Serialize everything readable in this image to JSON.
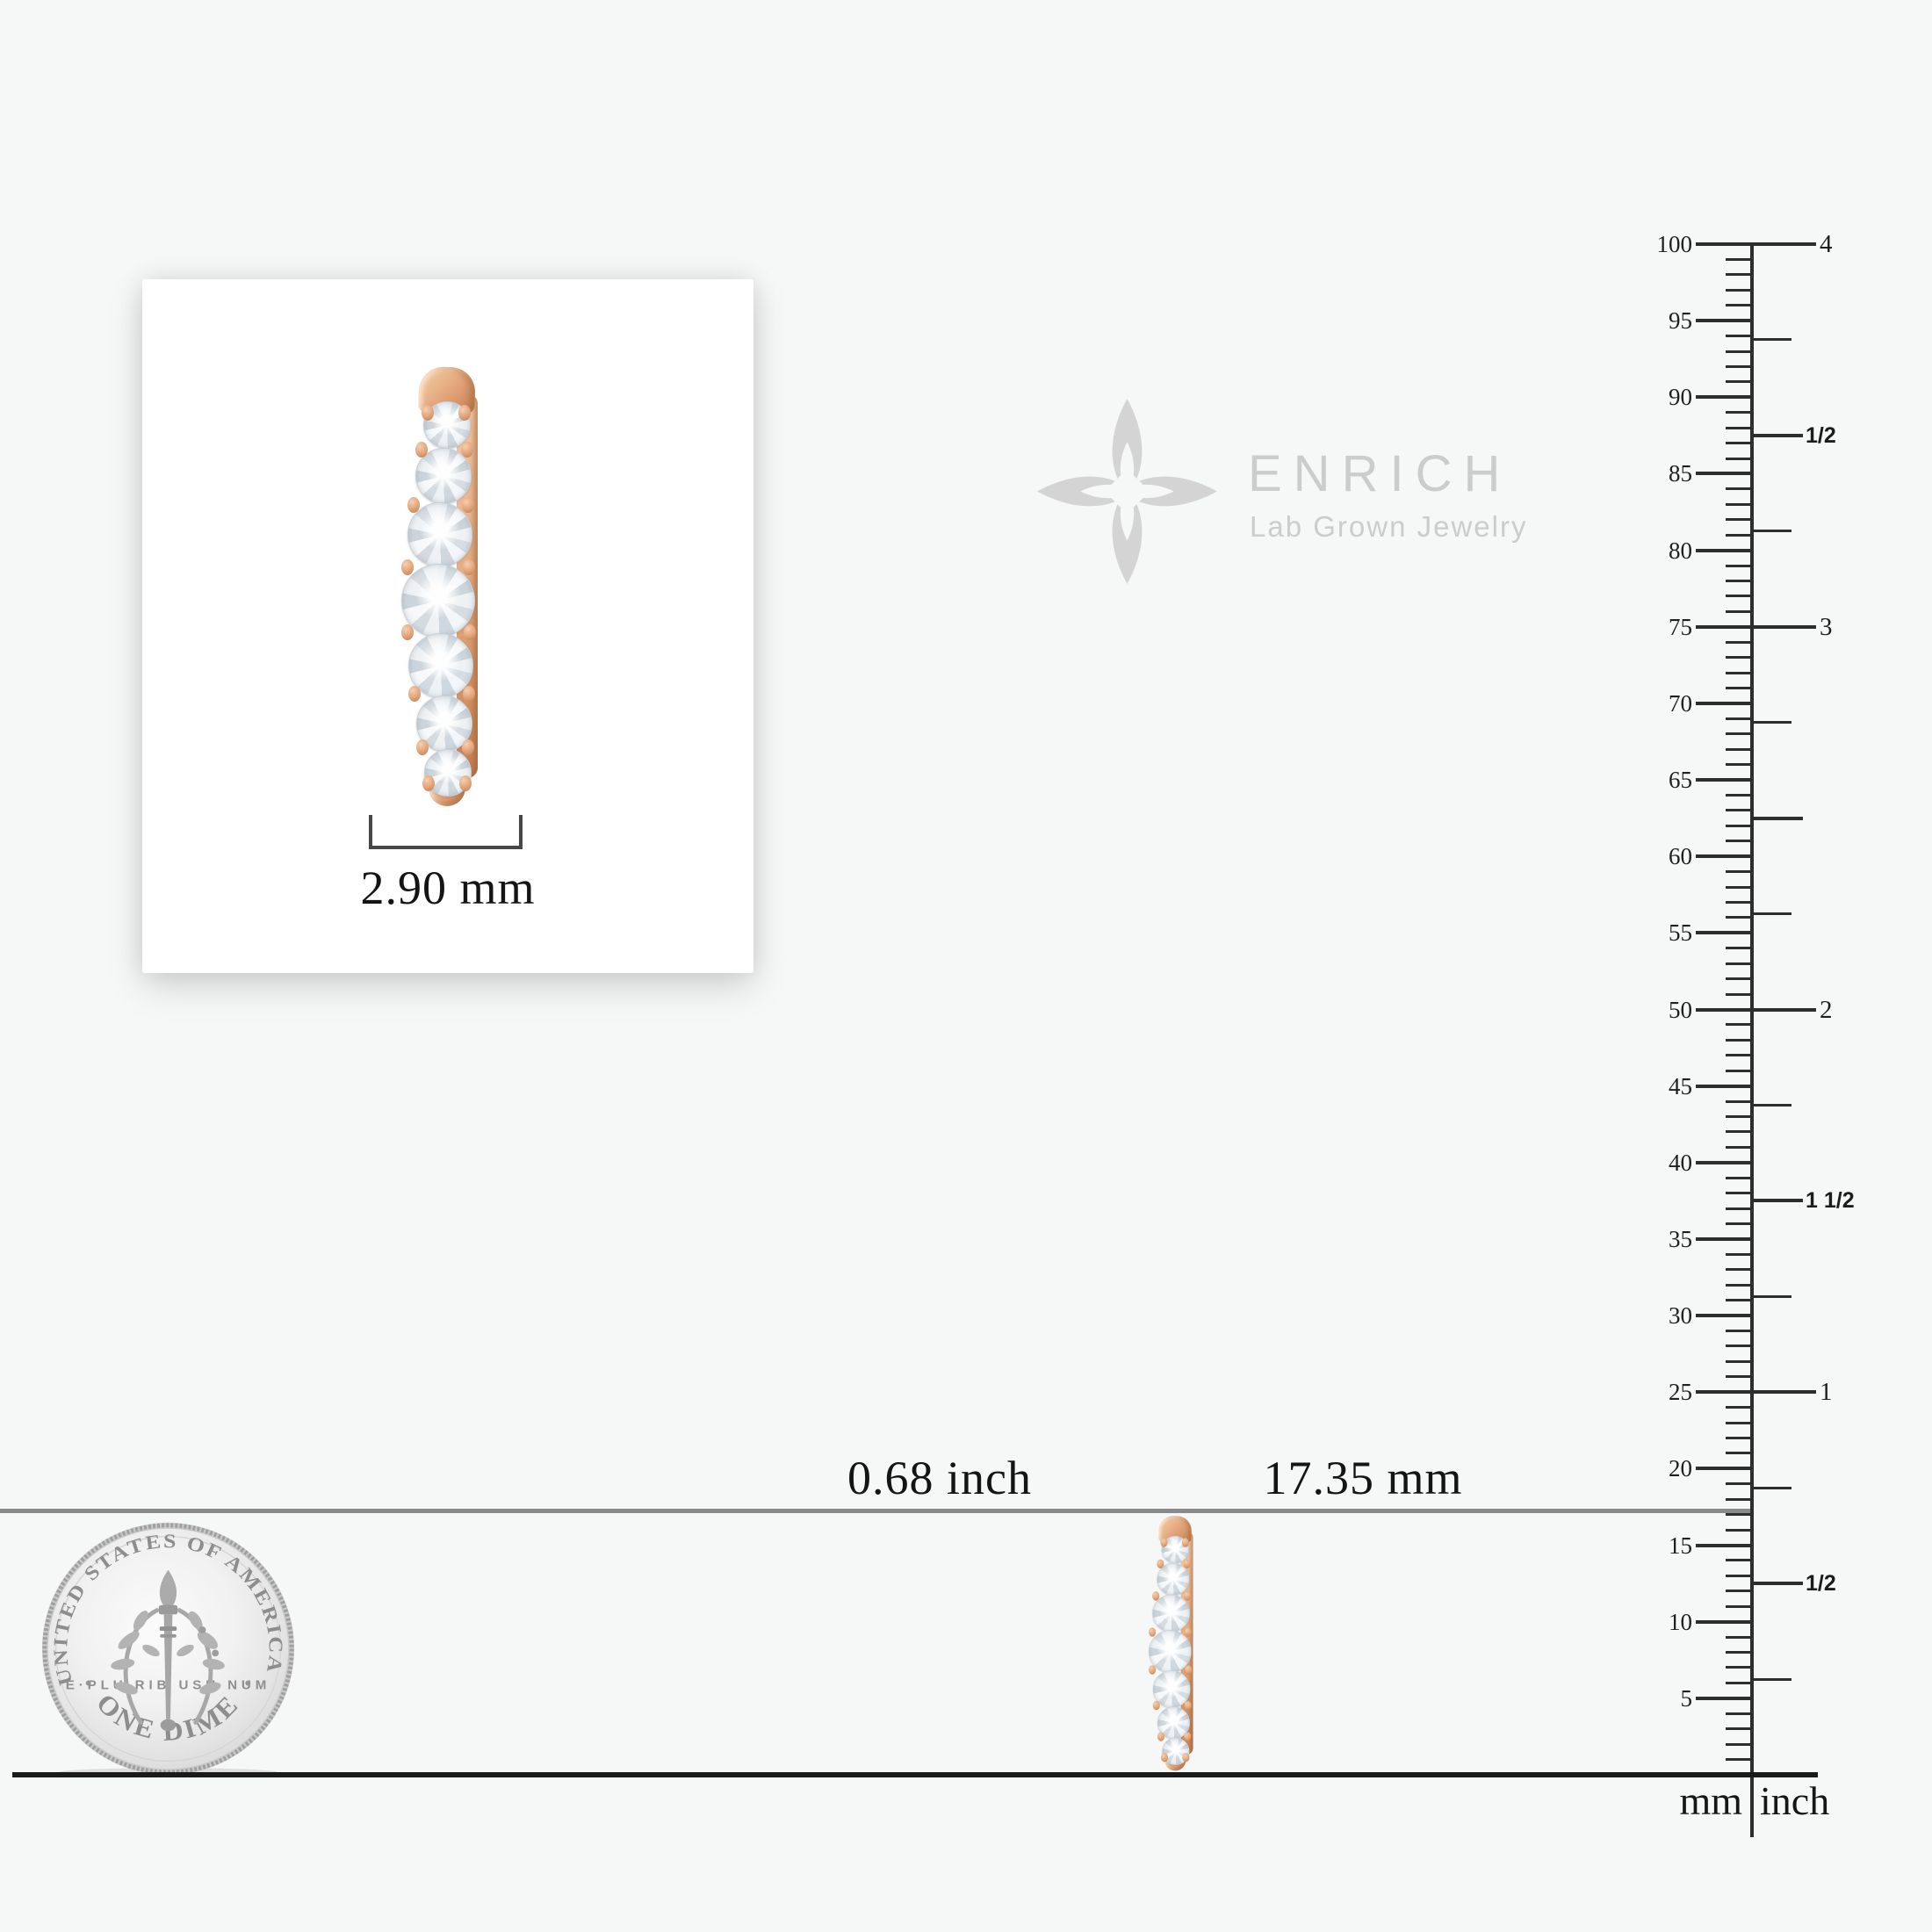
{
  "brand": {
    "name": "ENRICH",
    "tagline": "Lab Grown Jewelry"
  },
  "card_measurement": {
    "width_label": "2.90 mm"
  },
  "scale_labels": {
    "inch": "0.68 inch",
    "mm": "17.35 mm"
  },
  "ruler": {
    "mm_labels": [
      100,
      95,
      90,
      85,
      80,
      75,
      70,
      65,
      60,
      55,
      50,
      45,
      40,
      35,
      30,
      25,
      20,
      15,
      10,
      5
    ],
    "inch_labels": [
      {
        "text": "4",
        "mm": 100,
        "style": "serif"
      },
      {
        "text": "1/2",
        "mm": 87.5,
        "style": "bold"
      },
      {
        "text": "3",
        "mm": 75,
        "style": "serif"
      },
      {
        "text": "2",
        "mm": 50,
        "style": "serif"
      },
      {
        "text": "1 1/2",
        "mm": 37.5,
        "style": "bold"
      },
      {
        "text": "1",
        "mm": 25,
        "style": "serif"
      },
      {
        "text": "1/2",
        "mm": 12.5,
        "style": "bold"
      }
    ],
    "unit_left": "mm",
    "unit_right": "inch"
  },
  "coin": {
    "top_text": "UNITED STATES OF AMERICA",
    "middle_text": "E·PLU RIB USU NUM",
    "bottom_text": "ONE DIME"
  },
  "colors": {
    "background": "#f6f7f7",
    "card": "#ffffff",
    "rose_gold": "#e2a87f",
    "reference_line_gray": "#8a8a8a",
    "baseline_black": "#1a1a1a",
    "ink": "#141414",
    "watermark_gray": "#cccccc"
  }
}
